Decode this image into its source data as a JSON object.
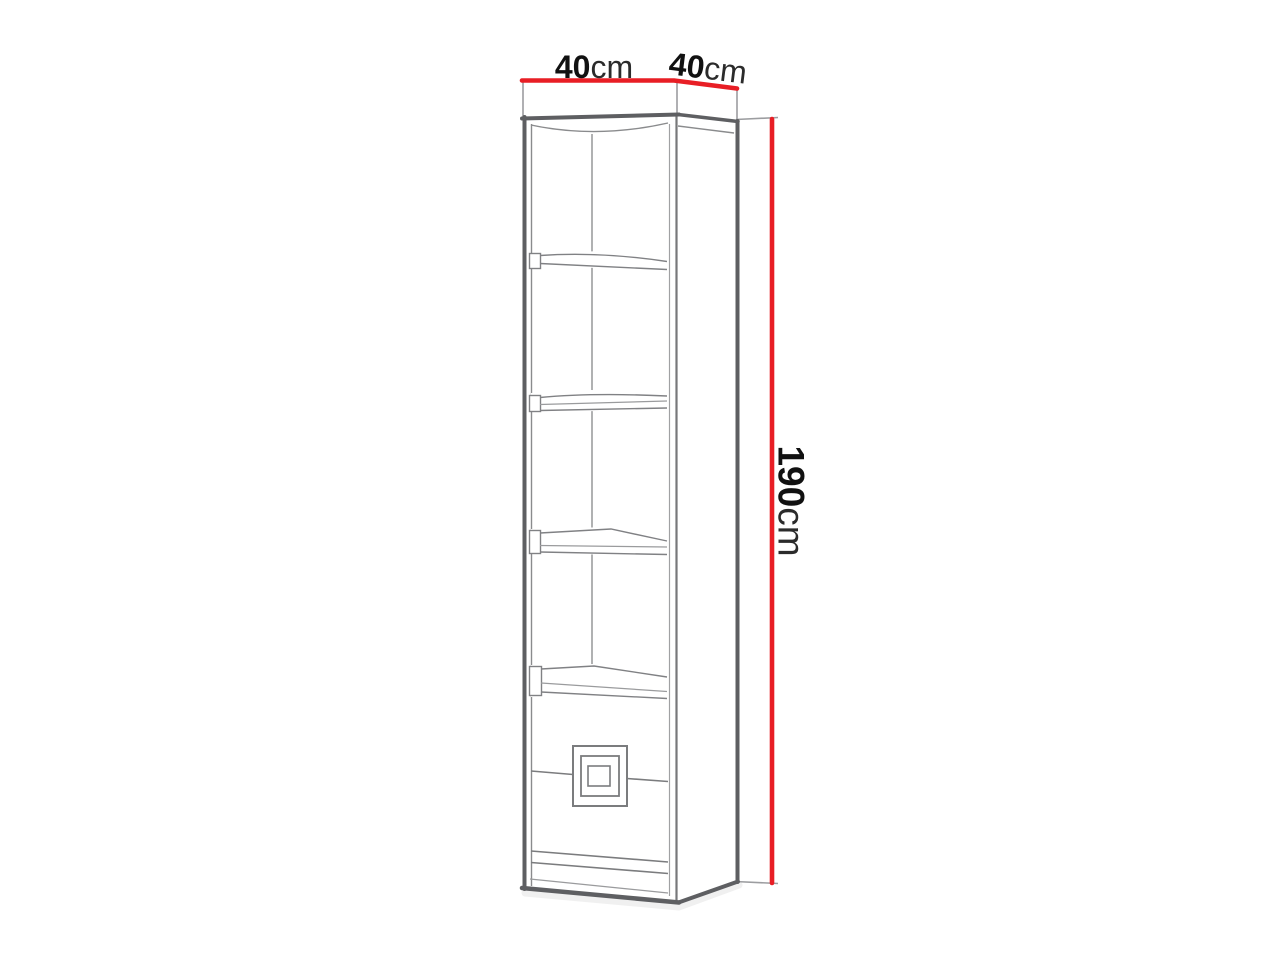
{
  "diagram": {
    "figure": "bookcase-outline-drawing",
    "shelf_count": 4,
    "dimensions": {
      "width": {
        "value": "40",
        "unit": "cm"
      },
      "depth": {
        "value": "40",
        "unit": "cm"
      },
      "height": {
        "value": "190",
        "unit": "cm"
      }
    },
    "colors": {
      "background": "#ffffff",
      "dimension_line": "#e81e25",
      "outline": "#5e5f62",
      "detail_line": "#87888b",
      "text": "#111111"
    }
  }
}
